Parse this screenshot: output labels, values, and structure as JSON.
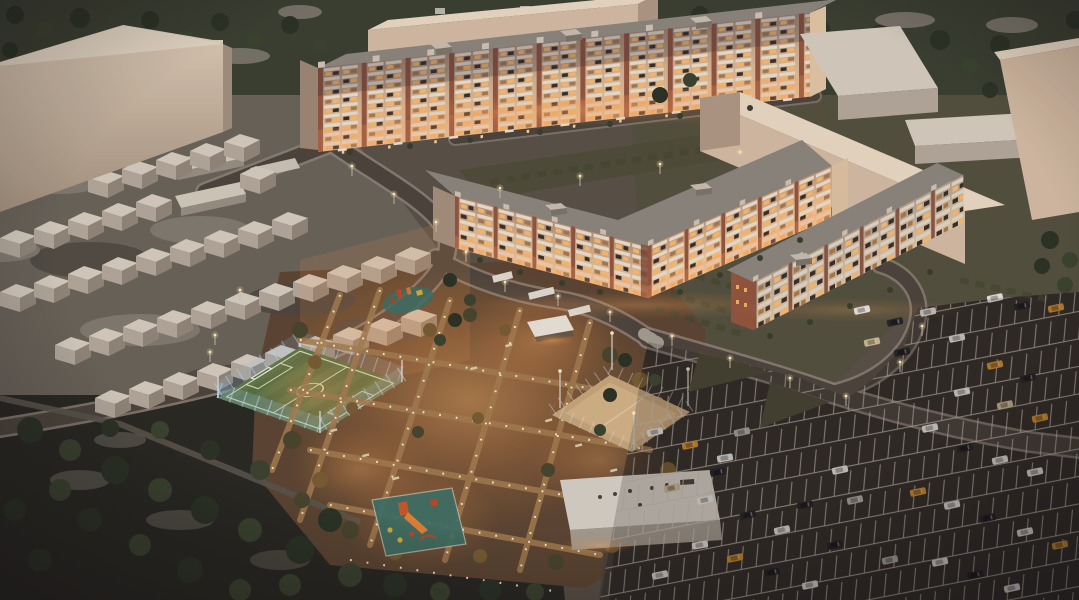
{
  "scene": {
    "type": "3d-architectural-masterplan-render",
    "time_of_day": "dusk",
    "view": "high oblique aerial view",
    "description": "Dusk aerial render of a residential quarter: long multi-storey brick apartment blocks with warmly lit windows, an L-shaped five-storey block and a four-storey block, beige warehouse and industrial slabs, rows of gabled garages on mottled ground, a blue-fenced green football pitch, a sand sports court, a glowing landscaped courtyard with playgrounds, pergolas and path lights, dark woodland, and a large half-filled car park with white stall markings."
  },
  "elements": [
    {
      "name": "industrial-building-top-left",
      "description": "Large blank beige L-shaped industrial block"
    },
    {
      "name": "apartment-block-long",
      "description": "Nine-storey apartment slab with brick piers, white balconies and lit windows"
    },
    {
      "name": "apartment-block-l-shaped",
      "description": "Five-storey L-shaped apartment block around the courtyard"
    },
    {
      "name": "apartment-block-small",
      "description": "Four-storey apartment block with red brick end wall"
    },
    {
      "name": "warehouse-slab",
      "description": "Long windowless beige slab building"
    },
    {
      "name": "warehouses-north-east",
      "description": "Flat warehouses with pale roofs among trees"
    },
    {
      "name": "garage-rows",
      "description": "Diagonal rows of small gabled garages"
    },
    {
      "name": "football-pitch",
      "description": "Green pitch with white markings inside translucent blue fence"
    },
    {
      "name": "sand-court",
      "description": "Sand sports court with perimeter fence and flood masts"
    },
    {
      "name": "courtyard-park",
      "description": "Warmly lit courtyard with paths, path lights, trees, benches, pergolas, pavilion and playgrounds"
    },
    {
      "name": "playground-main",
      "description": "Teal rubber mat with orange and red play equipment"
    },
    {
      "name": "utility-building",
      "description": "Flat-roofed white service building"
    },
    {
      "name": "parking-lot",
      "description": "Large asphalt car park with white stall lines and scattered cars"
    },
    {
      "name": "forest",
      "description": "Dark woodland in the lower left"
    },
    {
      "name": "road-network",
      "description": "Dark roads with pale sidewalks and street lights"
    }
  ],
  "counts": {
    "cars_visible_approx": "40",
    "garage_units_approx": "38",
    "street_lights_approx": "20"
  },
  "colors": {
    "base": "#5b5248",
    "topBand": "#3c4132",
    "forest": "#2b2a23",
    "treeDark": "#2d3426",
    "treeMid": "#3c4530",
    "treeLight": "#535c40",
    "grayPatch": "#7a756a",
    "mottleBase": "#6b655b",
    "mottleDark": "#4e4942",
    "mottleLight": "#8a8377",
    "road": "#4e463d",
    "sidewalk": "#90857a",
    "asphalt": "#38322c",
    "stallLine": "#cfc7ba",
    "bigBldg": "#d3bfa9",
    "bigBldgShade": "#a5937f",
    "roofGray": "#8e8880",
    "parapet": "#d2c7b6",
    "brick": "#96573f",
    "balcony": "#efe3d1",
    "winDark": "#3a2f28",
    "winLit": "#ffbe6e",
    "winDim": "#a97d4f",
    "glow": "#ff9d4e",
    "slabFace": "#d8bfa6",
    "slabTop": "#ecdcc6",
    "slabEnd": "#b29b85",
    "garageRoof": "#d9d0c2",
    "garageFace": "#b7ac9e",
    "garageSide": "#958a7c",
    "field": "#5c7245",
    "fieldStripe": "#68804f",
    "fieldLine": "#d8e8c6",
    "fenceBlue": "#8fc0e0",
    "sand": "#c9a87c",
    "sandLight": "#dcbc8e",
    "parkBase": "#5e4733",
    "pathWarm": "#a88052",
    "lightDot": "#fff1c8",
    "parkTree": "#4a472e",
    "parkTreeWarm": "#7a5f34",
    "benchTan": "#e0cfa8",
    "playTeal": "#3f7266",
    "playRed": "#c2492a",
    "playOrange": "#e0772e",
    "playYellow": "#d8ae3c",
    "pavilion": "#ece7db",
    "utilRoof": "#d9d3c7",
    "utilSide": "#a89f92",
    "carWhite": "#e9e7e0",
    "carDark": "#26262a",
    "carSilver": "#b6b2aa",
    "carOrange": "#d79434",
    "carTan": "#cdbb92",
    "grassPad": "#504e3a",
    "bushRow": "#474b33",
    "wall": "#5c564d"
  }
}
